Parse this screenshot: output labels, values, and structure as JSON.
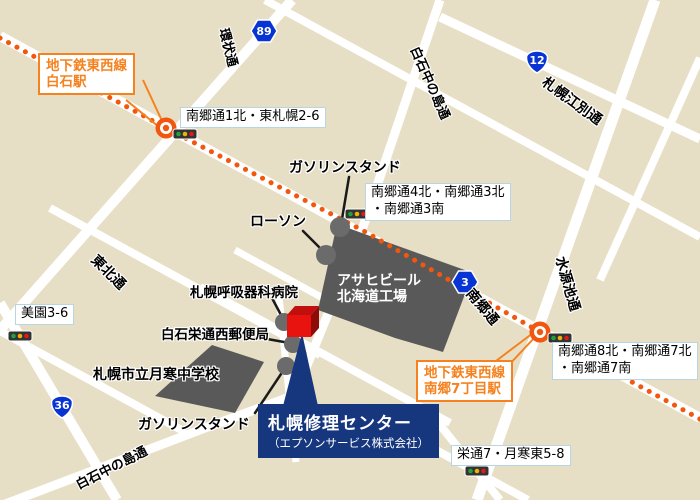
{
  "colors": {
    "background": "#e7dfc5",
    "road": "#ffffff",
    "subway_line_orange": "#f2570f",
    "station_accent_orange": "#f5821f",
    "intersection_label_border": "#b7d6e2",
    "building_gray": "#595959",
    "poi_dot_gray": "#6b6b6b",
    "route_shield_blue": "#0834d4",
    "destination_navy": "#16367e",
    "destination_marker_red": "#e8120e"
  },
  "destination": {
    "name": "札幌修理センター",
    "company": "（エプソンサービス株式会社）"
  },
  "subway_stations": [
    {
      "line": "地下鉄東西線",
      "station": "白石駅"
    },
    {
      "line": "地下鉄東西線",
      "station": "南郷7丁目駅"
    }
  ],
  "route_shields": [
    {
      "number": "89"
    },
    {
      "number": "12"
    },
    {
      "number": "3"
    },
    {
      "number": "36"
    }
  ],
  "road_labels": [
    {
      "name": "環状通"
    },
    {
      "name": "白石中の島通"
    },
    {
      "name": "札幌江別通"
    },
    {
      "name": "南郷通"
    },
    {
      "name": "水源池通"
    },
    {
      "name": "東北通"
    },
    {
      "name": "白石中の島通"
    }
  ],
  "intersection_labels": [
    {
      "text": "南郷通1北・東札幌2-6"
    },
    {
      "line1": "南郷通4北・南郷通3北",
      "line2": "・南郷通3南"
    },
    {
      "text": "美園3-6"
    },
    {
      "line1": "南郷通8北・南郷通7北",
      "line2": "・南郷通7南"
    },
    {
      "text": "栄通7・月寒東5-8"
    }
  ],
  "pois": [
    {
      "label": "ガソリンスタンド"
    },
    {
      "label": "ローソン"
    },
    {
      "label": "札幌呼吸器科病院"
    },
    {
      "label": "白石栄通西郵便局"
    },
    {
      "label": "札幌市立月寒中学校"
    },
    {
      "label": "ガソリンスタンド"
    }
  ],
  "buildings": [
    {
      "line1": "アサヒビール",
      "line2": "北海道工場"
    }
  ]
}
